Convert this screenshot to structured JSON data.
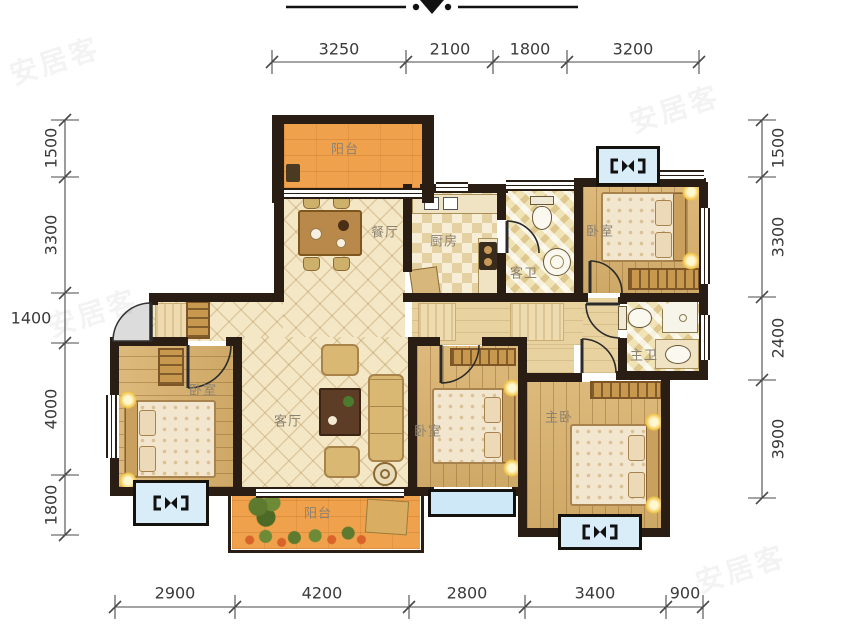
{
  "watermark": "安居客",
  "rooms": {
    "balcony_top": "阳台",
    "dining": "餐厅",
    "kitchen": "厨房",
    "guest_bath": "客卫",
    "bedroom_top_right": "卧室",
    "master_bath": "主卫",
    "bedroom_left": "卧室",
    "living": "客厅",
    "bedroom_middle": "卧室",
    "master_bedroom": "主卧",
    "balcony_bottom": "阳台"
  },
  "dimensions": {
    "top": [
      "3250",
      "2100",
      "1800",
      "3200"
    ],
    "bottom": [
      "2900",
      "4200",
      "2800",
      "3400",
      "900"
    ],
    "left": [
      "1500",
      "3300",
      "1400",
      "4000",
      "1800"
    ],
    "right": [
      "1500",
      "3300",
      "2400",
      "3900"
    ]
  },
  "colors": {
    "wall": "#2a1d13",
    "balcony_floor": "#f0a14c",
    "wood_floor": "#d9b16c",
    "lattice_floor": "#f4e7c6",
    "bath_floor": "#f0e3b6",
    "window_blue": "#cfe8f8",
    "dimension_text": "#3a3a3a",
    "room_label": "#8b8272"
  }
}
